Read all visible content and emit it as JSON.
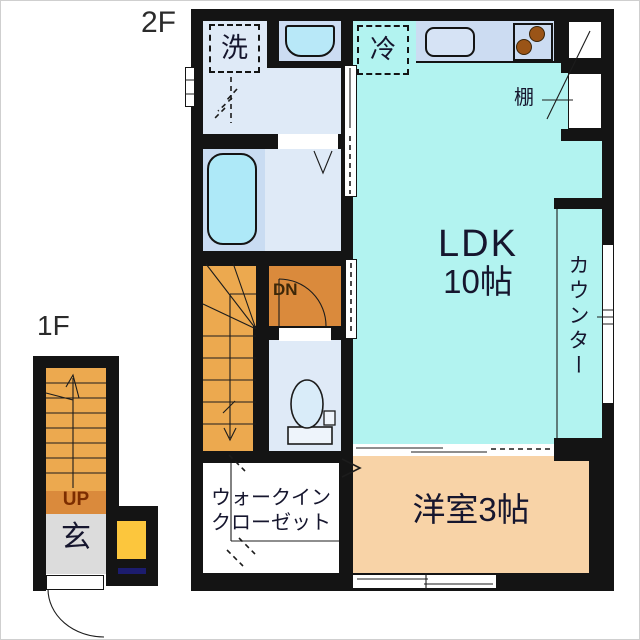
{
  "floor_plan": {
    "title_2f": "2F",
    "title_1f": "1F",
    "rooms": {
      "ldk_name": "LDK",
      "ldk_size": "10帖",
      "western_room": "洋室3帖",
      "walkin_line1": "ウォークイン",
      "walkin_line2": "クローゼット",
      "counter": "カウンター",
      "entrance": "玄"
    },
    "fixtures": {
      "washer": "洗",
      "fridge": "冷",
      "shelf": "棚"
    },
    "stairs": {
      "down": "DN",
      "up": "UP"
    },
    "colors": {
      "wall": "#141414",
      "line": "#1c1c1c",
      "ldk": "#b2f3f0",
      "room_blue": "#dfeaf7",
      "counter_blue": "#ccdcf2",
      "bath_floor": "#c9dcf2",
      "tub": "#aee9f8",
      "basin": "#b8e8f8",
      "kitchen_sink": "#d6e3f5",
      "stove": "#9a5417",
      "stairs": "#eca94f",
      "landing": "#da8a3c",
      "western": "#f8d3a7",
      "shoe_box": "#fcc63d",
      "entrance_gray": "#dcdcdc",
      "navy": "#1c1c6e",
      "text": "#16162e",
      "up_text": "#7c2d00",
      "dn_text": "#3d2708"
    }
  }
}
